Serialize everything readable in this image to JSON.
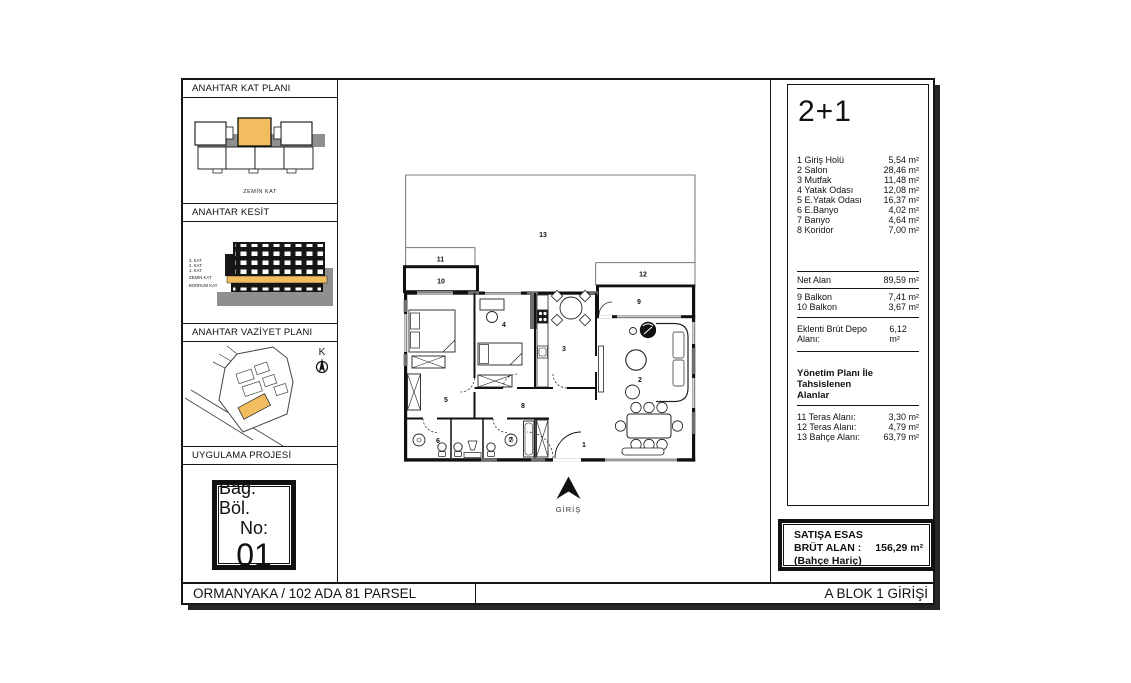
{
  "colors": {
    "highlight": "#F2BD5F",
    "wall": "#111111",
    "gray": "#6e6e6e"
  },
  "sidebar": {
    "sections": {
      "kat_plani": {
        "title": "ANAHTAR KAT PLANI",
        "caption": "ZEMİN KAT"
      },
      "kesit": {
        "title": "ANAHTAR KESİT",
        "floors": [
          "3. KAT",
          "2. KAT",
          "1. KAT",
          "ZEMİN KAT",
          "BODRUM KAT"
        ]
      },
      "vaziyet": {
        "title": "ANAHTAR VAZİYET PLANI",
        "north": "K"
      },
      "uygulama": {
        "title": "UYGULAMA PROJESİ"
      }
    },
    "unit_box": {
      "line1": "Bağ. Böl.",
      "line2": "No:",
      "number": "01"
    }
  },
  "plan": {
    "labels": {
      "r1": "1",
      "r2": "2",
      "r3": "3",
      "r4": "4",
      "r5": "5",
      "r6": "6",
      "r7": "7",
      "r8": "8",
      "r9": "9",
      "r10": "10",
      "r11": "11",
      "r12": "12",
      "r13": "13"
    },
    "entrance": "GİRİŞ"
  },
  "right_panel": {
    "unit_type": "2+1",
    "rooms": [
      {
        "label": "1 Giriş Holü",
        "value": "5,54 m²"
      },
      {
        "label": "2 Salon",
        "value": "28,46 m²"
      },
      {
        "label": "3 Mutfak",
        "value": "11,48 m²"
      },
      {
        "label": "4 Yatak Odası",
        "value": "12,08 m²"
      },
      {
        "label": "5 E.Yatak Odası",
        "value": "16,37 m²"
      },
      {
        "label": "6 E.Banyo",
        "value": "4,02 m²"
      },
      {
        "label": "7 Banyo",
        "value": "4,64 m²"
      },
      {
        "label": "8 Koridor",
        "value": "7,00 m²"
      }
    ],
    "net": {
      "label": "Net Alan",
      "value": "89,59 m²"
    },
    "balconies": [
      {
        "label": "9 Balkon",
        "value": "7,41 m²"
      },
      {
        "label": "10 Balkon",
        "value": "3,67 m²"
      }
    ],
    "depo": {
      "label": "Eklenti Brüt Depo Alanı:",
      "value": "6,12 m²"
    },
    "yonetim": {
      "header_line1": "Yönetim Planı İle Tahsislenen",
      "header_line2": "Alanlar",
      "rows": [
        {
          "label": "11 Teras Alanı:",
          "value": "3,30 m²"
        },
        {
          "label": "12 Teras Alanı:",
          "value": "4,79 m²"
        },
        {
          "label": "13 Bahçe Alanı:",
          "value": "63,79 m²"
        }
      ]
    }
  },
  "sales_box": {
    "line1": "SATIŞA ESAS",
    "label": "BRÜT ALAN :",
    "value": "156,29 m²",
    "line3": "(Bahçe Hariç)"
  },
  "footer": {
    "left": "ORMANYAKA / 102 ADA 81 PARSEL",
    "right": "A BLOK 1 GİRİŞİ"
  }
}
